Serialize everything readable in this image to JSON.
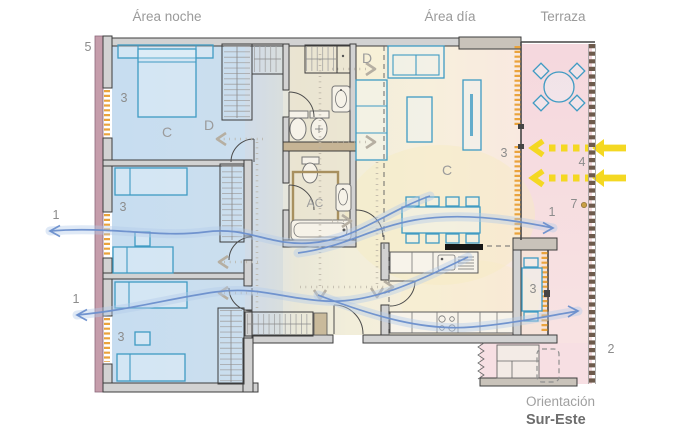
{
  "areas": {
    "night": "Área noche",
    "day": "Área día",
    "terrace": "Terraza"
  },
  "orientation": {
    "label": "Orientación",
    "value": "Sur-Este"
  },
  "letters": {
    "c": "C",
    "d": "D",
    "ac": "AC"
  },
  "numbers": {
    "n1": "1",
    "n2": "2",
    "n3": "3",
    "n4": "4",
    "n5": "5",
    "n7": "7"
  },
  "colors": {
    "night_zone": "#cfe2f3",
    "day_zone": "#f2eeda",
    "terrace_zone": "#f6dade",
    "exterior_wall": "#c59dab",
    "window_glazing": "#eaa33c",
    "furniture": "#3f9bc3",
    "airflow": "#6b8fcc",
    "sunlight": "#f4d822",
    "circulation": "#b6afa2",
    "railing": "#6d5a4c"
  }
}
